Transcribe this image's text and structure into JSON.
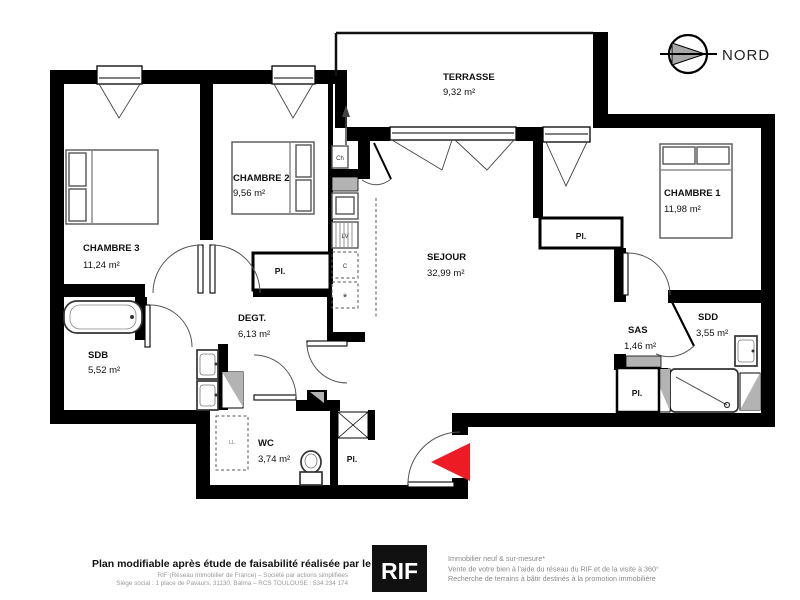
{
  "plan": {
    "rooms": {
      "terrasse": {
        "name": "TERRASSE",
        "area": "9,32 m²"
      },
      "chambre1": {
        "name": "CHAMBRE 1",
        "area": "11,98 m²"
      },
      "chambre2": {
        "name": "CHAMBRE 2",
        "area": "9,56 m²"
      },
      "chambre3": {
        "name": "CHAMBRE 3",
        "area": "11,24 m²"
      },
      "sejour": {
        "name": "SEJOUR",
        "area": "32,99 m²"
      },
      "degt": {
        "name": "DEGT.",
        "area": "6,13 m²"
      },
      "sdb": {
        "name": "SDB",
        "area": "5,52 m²"
      },
      "wc": {
        "name": "WC",
        "area": "3,74 m²"
      },
      "sas": {
        "name": "SAS",
        "area": "1,46 m²"
      },
      "sdd": {
        "name": "SDD",
        "area": "3,55 m²"
      }
    },
    "closets": [
      "Pl.",
      "Pl.",
      "Pl.",
      "Pl."
    ],
    "appliances": {
      "water_heater": "Ch",
      "dishwasher": "LV",
      "cooker": "C",
      "fridge": "*",
      "laundry": "LL"
    },
    "compass_label": "NORD",
    "colors": {
      "entrance_arrow": "#ed1c24",
      "duct_gray": "#b3b3b3",
      "wall": "#000000"
    }
  },
  "footer": {
    "headline": "Plan modifiable après étude de faisabilité réalisée par le RIF",
    "legal_line1": "RIF (Réseau Immobilier de France) – Société par actions simplifiées",
    "legal_line2": "Siège social : 1 place de Pavaurs, 31130, Balma – RCS TOULOUSE : 534 234 174",
    "logo": "RIF",
    "services": [
      "Immobilier neuf & sur-mesure*",
      "Vente de votre bien à l'aide du réseau du RIF et de la visite à 360°",
      "Recherche de terrains à bâtir destinés à la promotion immobilière"
    ]
  }
}
